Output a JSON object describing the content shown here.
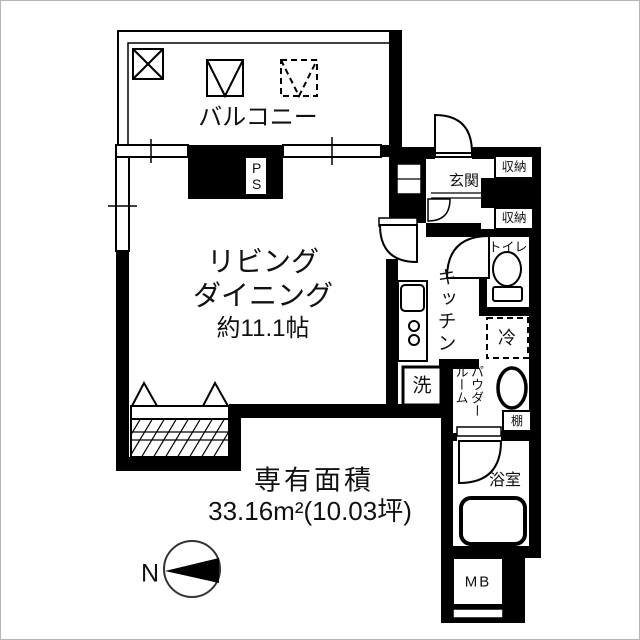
{
  "labels": {
    "balcony": "バルコニー",
    "living_line1": "リビング",
    "living_line2": "ダイニング",
    "living_size": "約11.1帖",
    "entrance": "玄関",
    "storage_upper": "収納",
    "storage_lower": "収納",
    "toilet": "トイレ",
    "kitchen": "キッチン",
    "fridge": "冷",
    "washer": "洗",
    "powder_room": "パウダールーム",
    "shelf": "棚",
    "bathroom": "浴室",
    "meter_box": "MB",
    "pipe_space": "PS",
    "north": "N"
  },
  "area": {
    "title": "専有面積",
    "value": "33.16m²(10.03坪)"
  },
  "colors": {
    "wall": "#000000",
    "text": "#111111",
    "background": "#ffffff"
  }
}
